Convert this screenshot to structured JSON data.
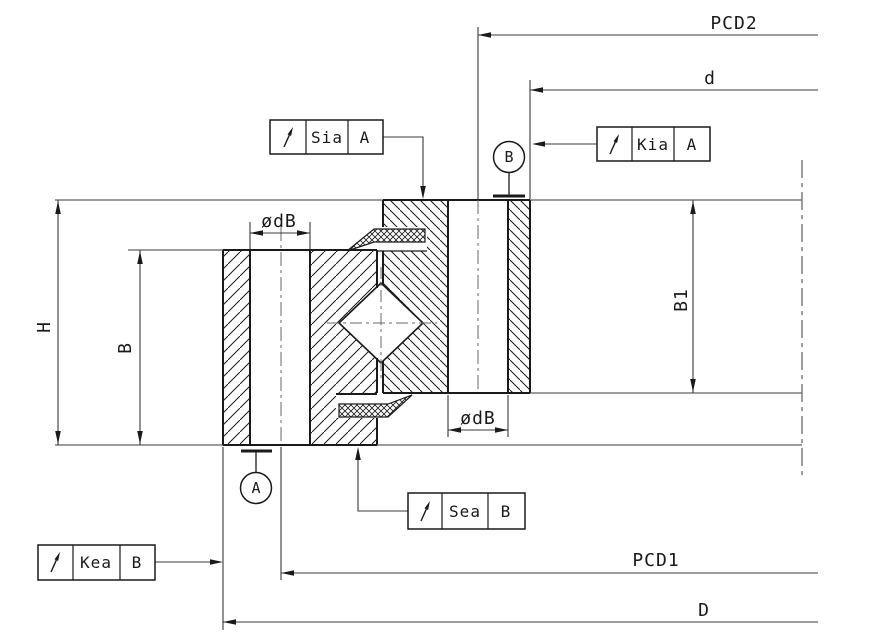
{
  "drawing": {
    "background": "#ffffff",
    "line_color": "#1a1a1a",
    "dim_color": "#3a3a3a",
    "dimensions": {
      "height_total": "H",
      "outer_ring_width": "B",
      "inner_ring_width": "B1",
      "bolt_hole_outer": "ødB",
      "bolt_hole_inner": "ødB",
      "pitch_circle_outer": "PCD1",
      "pitch_circle_inner": "PCD2",
      "bore_diameter": "d",
      "outside_diameter": "D"
    },
    "tolerance_frames": {
      "sia": {
        "symbol": "runout-arrow",
        "label": "Sia",
        "datum": "A"
      },
      "kia": {
        "symbol": "runout-arrow",
        "label": "Kia",
        "datum": "A"
      },
      "sea": {
        "symbol": "runout-arrow",
        "label": "Sea",
        "datum": "B"
      },
      "kea": {
        "symbol": "runout-arrow",
        "label": "Kea",
        "datum": "B"
      }
    },
    "datum_symbols": {
      "a": "A",
      "b": "B"
    }
  }
}
